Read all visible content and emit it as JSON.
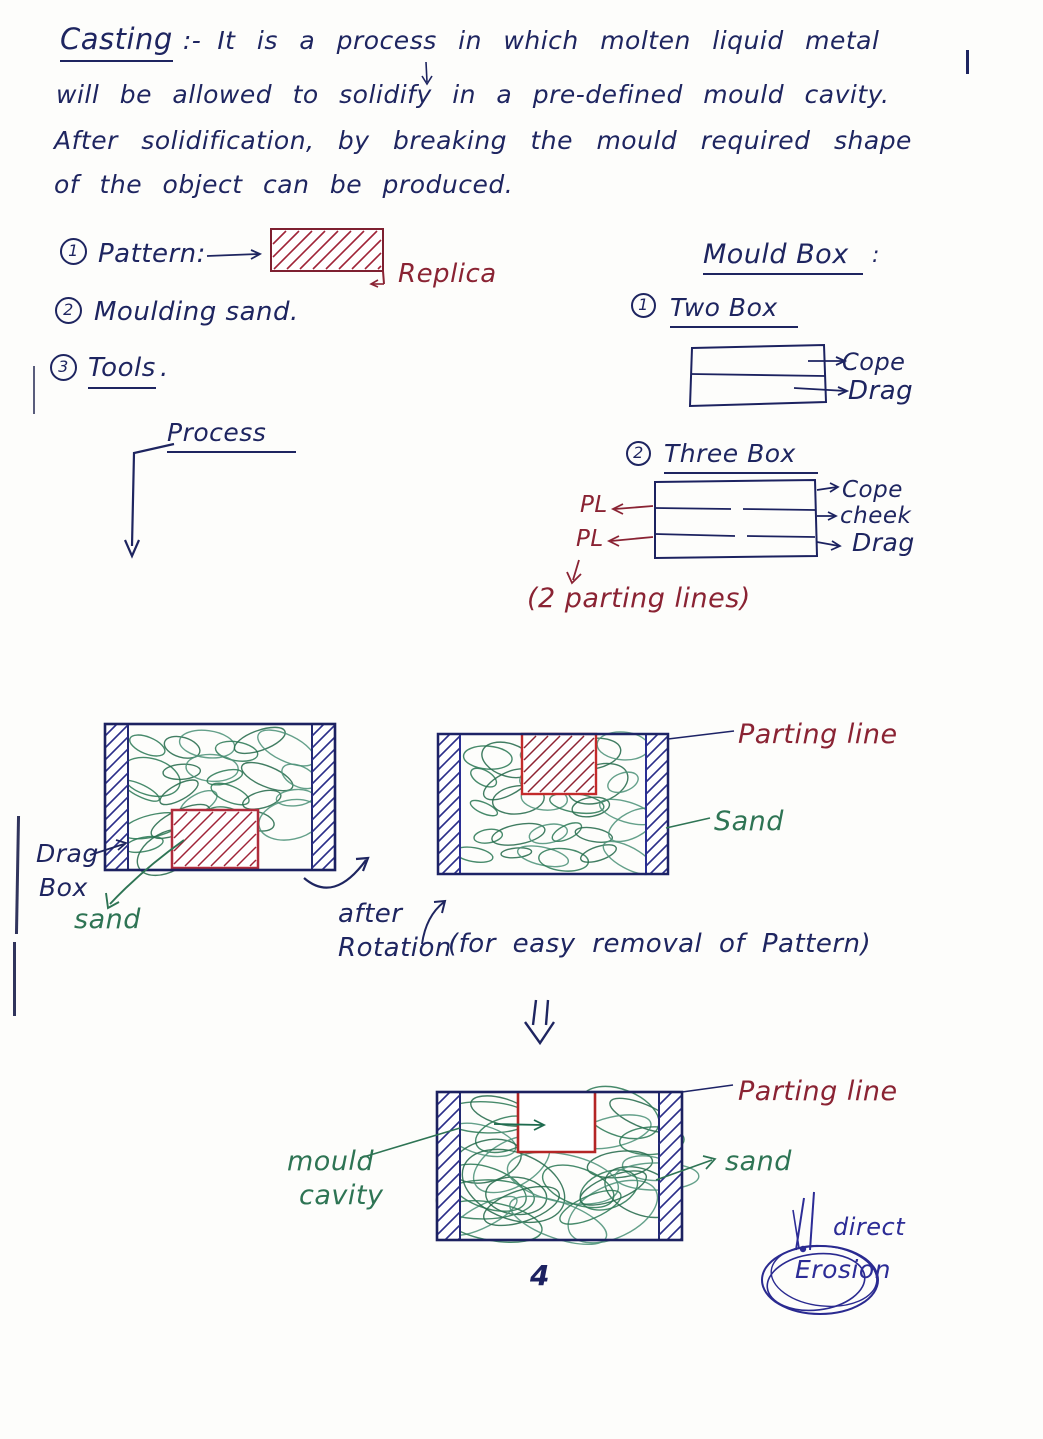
{
  "colors": {
    "ink_navy": "#1e2560",
    "ink_maroon": "#8a2333",
    "ink_green": "#2e7454",
    "ink_blue": "#2c2c96",
    "pattern_red": "#b02c3c"
  },
  "intro": {
    "title": "Casting",
    "separator": ":-",
    "lines": [
      "It is a process in which molten liquid metal",
      "will be allowed to solidify in a pre-defined mould cavity.",
      "After solidification, by breaking the mould required shape",
      "of the object can be produced."
    ]
  },
  "materials": {
    "item1": {
      "num": "1",
      "label": "Pattern:",
      "replica": "Replica"
    },
    "item2": {
      "num": "2",
      "label": "Moulding sand."
    },
    "item3": {
      "num": "3",
      "label": "Tools",
      "period": "."
    }
  },
  "mould_box": {
    "title": "Mould Box",
    "colon": ":",
    "two_box": {
      "num": "1",
      "label": "Two Box",
      "cope": "Cope",
      "drag": "Drag"
    },
    "three_box": {
      "num": "2",
      "label": "Three Box",
      "cope": "Cope",
      "cheek": "cheek",
      "drag": "Drag",
      "pl_top": "PL",
      "pl_bottom": "PL",
      "note": "(2 parting lines)"
    }
  },
  "process": {
    "label": "Process"
  },
  "drag_box_diagram": {
    "drag": "Drag",
    "box": "Box",
    "sand": "sand"
  },
  "rotation": {
    "word1": "after",
    "word2": "Rotation",
    "note": "(for easy removal of Pattern)"
  },
  "inverted_diagram": {
    "parting_line": "Parting line",
    "sand": "Sand"
  },
  "cavity_diagram": {
    "mould": "mould",
    "cavity": "cavity",
    "parting_line": "Parting line",
    "sand": "sand"
  },
  "erosion_note": {
    "direct": "direct",
    "erosion": "Erosion"
  },
  "page_number": "4"
}
